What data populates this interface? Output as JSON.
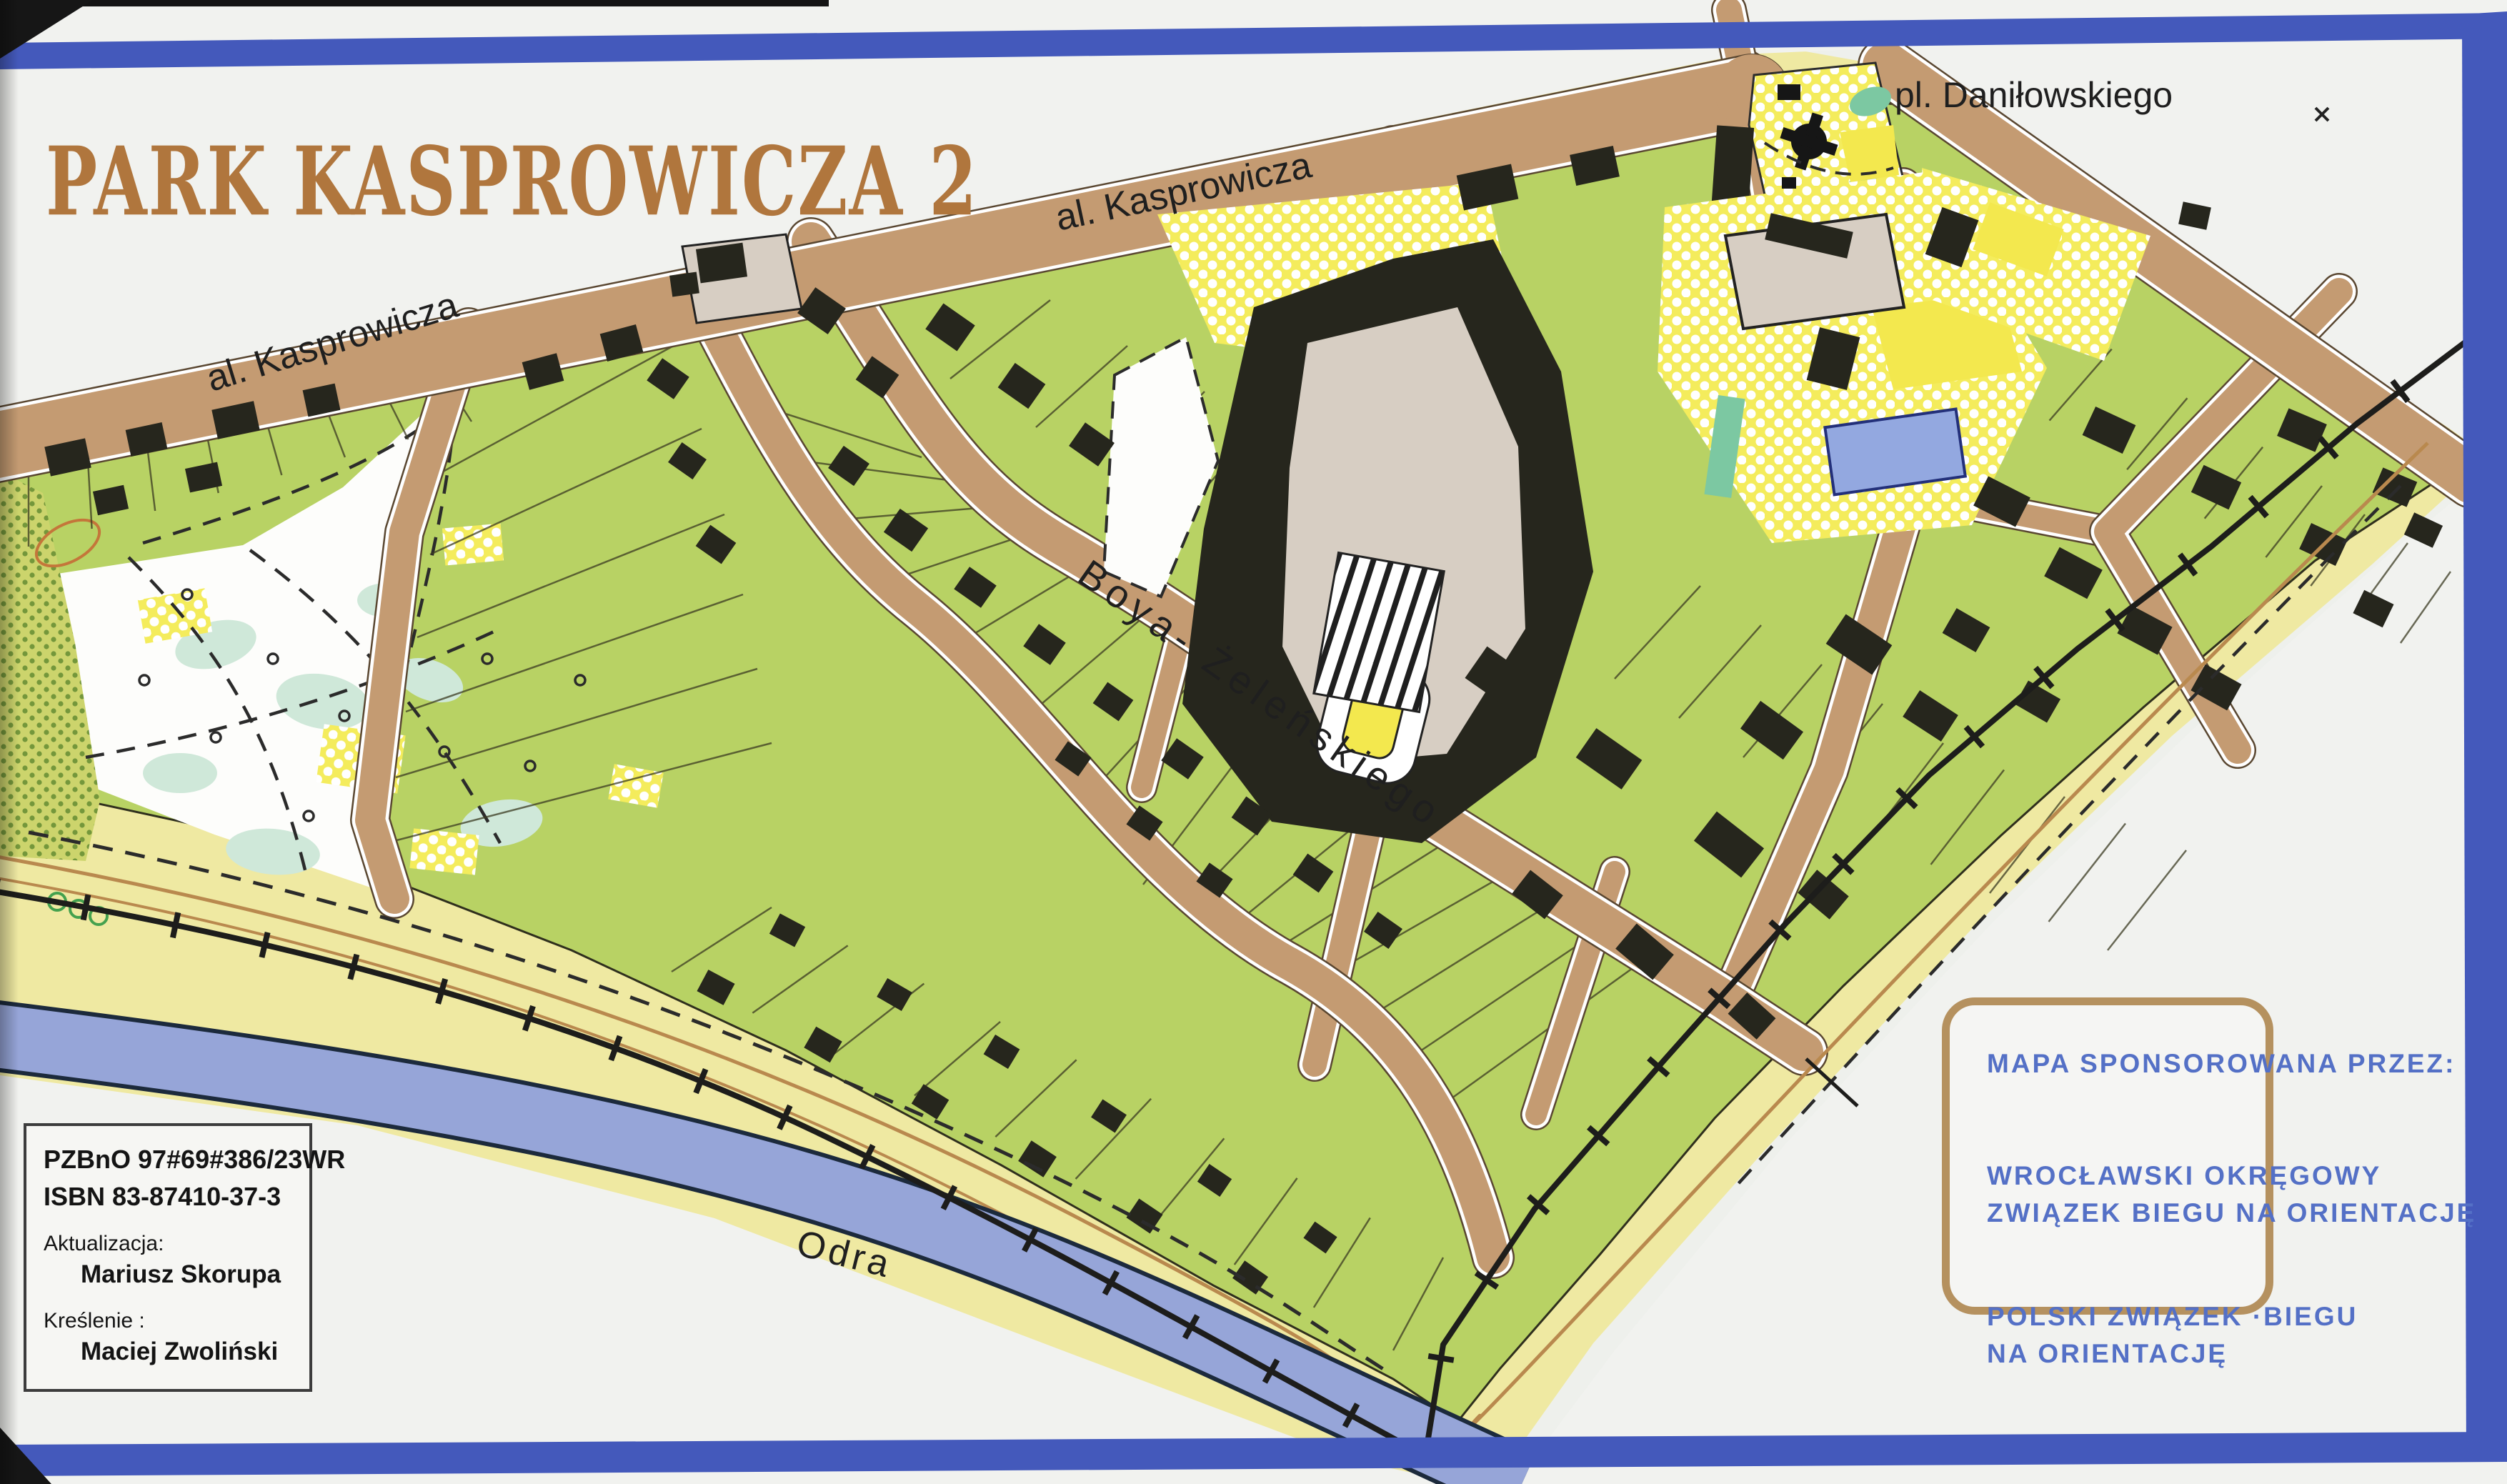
{
  "page": {
    "title": "PARK KASPROWICZA 2"
  },
  "map_labels": {
    "street_kasprowicza_left": "al. Kasprowicza",
    "street_kasprowicza_top": "al. Kasprowicza",
    "place_danilowskiego": "pl. Daniłowskiego",
    "street_boya_zelenskiego": "Boya- Żeleńskiego",
    "river_odra": "Odra"
  },
  "info_box": {
    "license": "PZBnO 97#69#386/23WR",
    "isbn": "ISBN 83-87410-37-3",
    "update_label": "Aktualizacja:",
    "update_name": "Mariusz Skorupa",
    "drafting_label": "Kreślenie :",
    "drafting_name": "Maciej Zwoliński"
  },
  "sponsor_box": {
    "heading": "MAPA SPONSOROWANA PRZEZ:",
    "sponsor1_line1": "WROCŁAWSKI OKRĘGOWY",
    "sponsor1_line2": "ZWIĄZEK BIEGU NA ORIENTACJĘ",
    "sponsor2_line1": "POLSKI ZWIĄZEK ·BIEGU",
    "sponsor2_line2": "NA ORIENTACJĘ"
  },
  "colors": {
    "frame": "#4459bb",
    "title": "#b0763d",
    "green": "#b8d264",
    "yellow": "#efe9a2",
    "brightYellow": "#f3e84e",
    "road": "#c49b72",
    "roadEdge": "#5a4731",
    "river": "#96a5d8",
    "riverEdge": "#1c2a3c",
    "building": "#26261d",
    "grey": "#d7cec3",
    "pool": "#93a8e0",
    "teal": "#7cc8a2",
    "mint": "#cfe8d9",
    "trail": "#b9894e",
    "sponsorText": "#5470c6",
    "boxBorder": "#b5915f",
    "mapWhite": "#fdfdfb"
  }
}
